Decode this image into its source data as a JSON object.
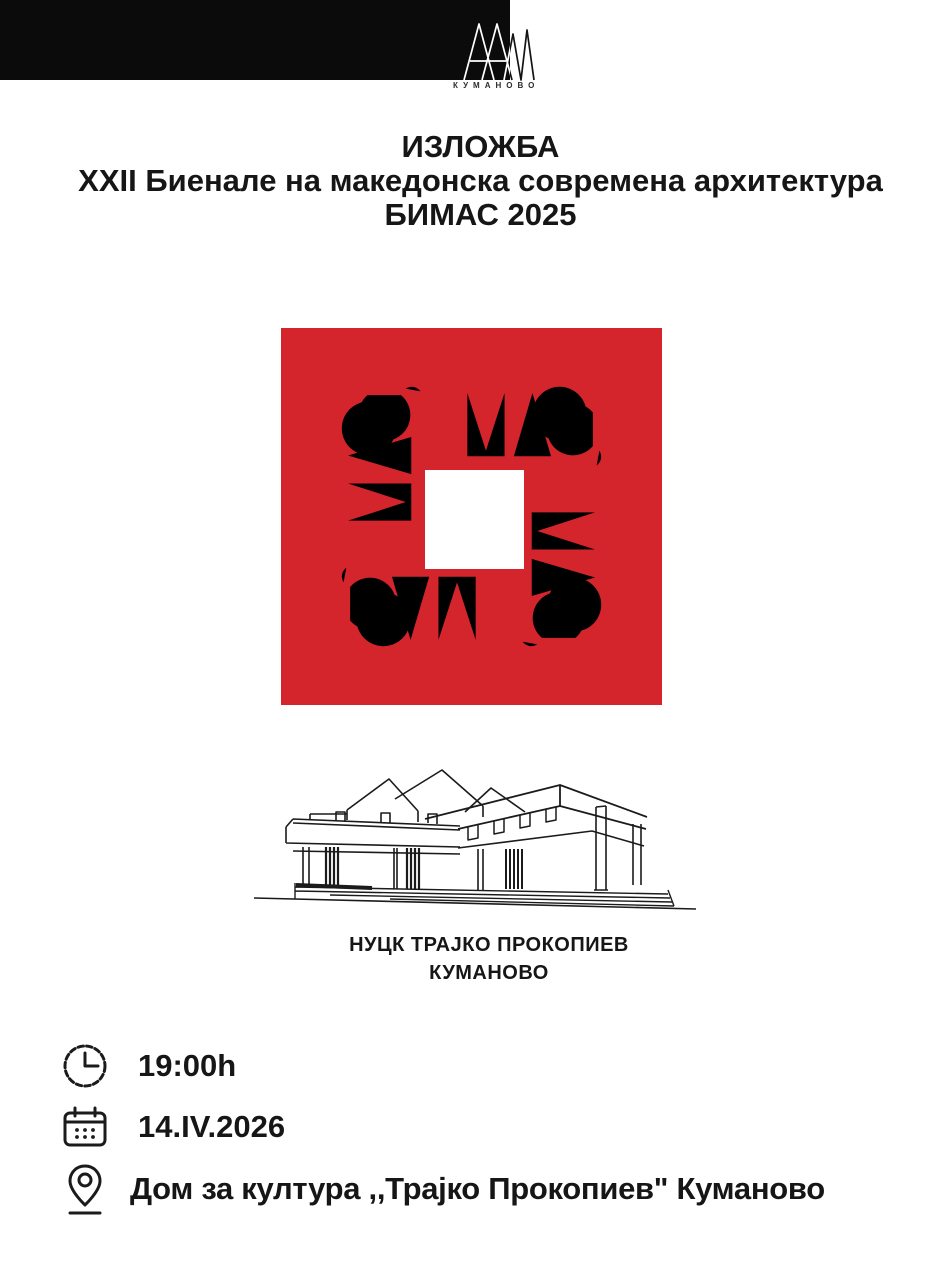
{
  "colors": {
    "brand_red": "#d5252c",
    "bar_black": "#0b0b0b",
    "ink": "#161616"
  },
  "header": {
    "org_initials": "ААМ",
    "org_city": "КУМАНОВО"
  },
  "title": {
    "line1": "ИЗЛОЖБА",
    "line2": "XXII Биенале на македонска современа архитектура",
    "line3": "БИМАС 2025"
  },
  "bimas_logo": {
    "word": "БИМАС"
  },
  "venue": {
    "name": "НУЦК ТРАЈКО ПРОКОПИЕВ",
    "city": "КУМАНОВО"
  },
  "details": {
    "time": {
      "icon": "clock-icon",
      "text": "19:00h"
    },
    "date": {
      "icon": "calendar-icon",
      "text": "14.IV.2026"
    },
    "location": {
      "icon": "location-pin-icon",
      "text": "Дом за култура ,,Трајко Прокопиев\" Куманово"
    }
  }
}
